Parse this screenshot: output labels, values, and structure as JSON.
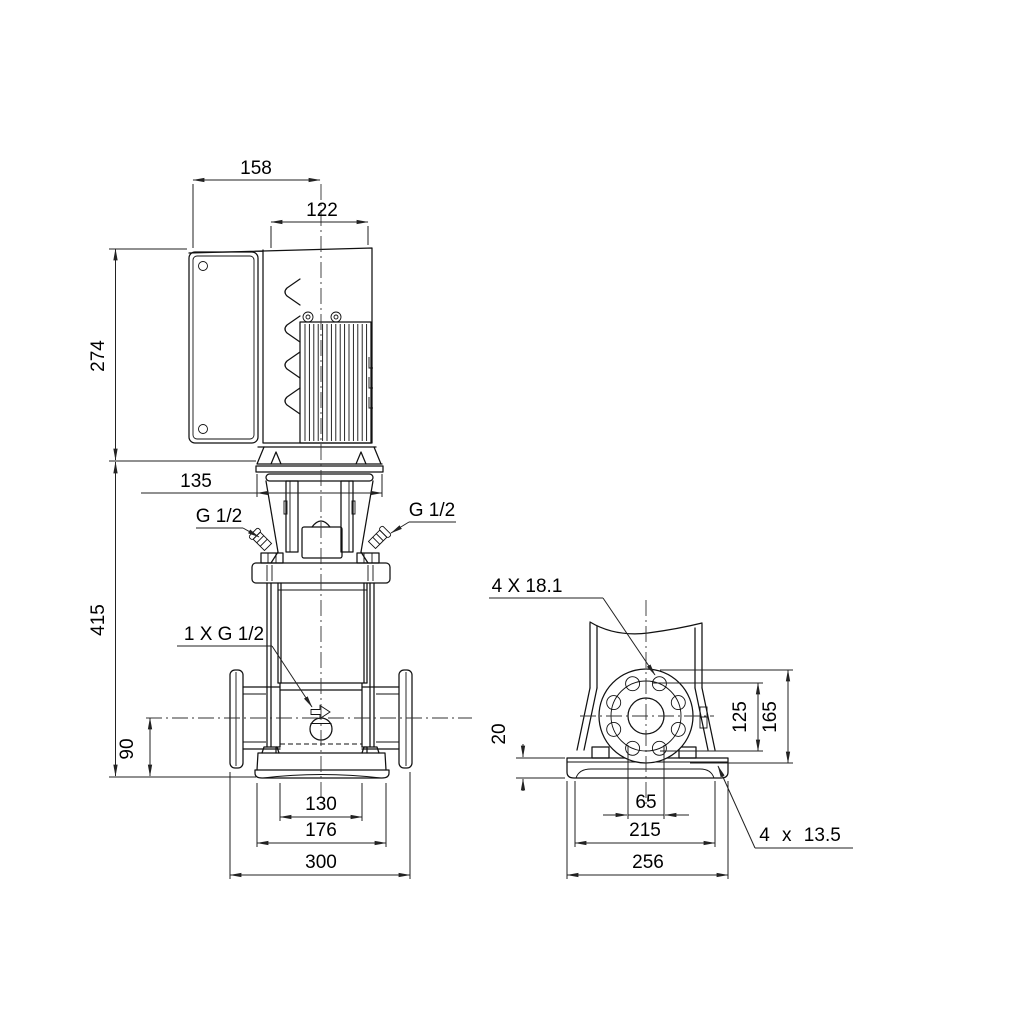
{
  "colors": {
    "background": "#ffffff",
    "line": "#000000"
  },
  "front_view": {
    "dim_total_width": "158",
    "dim_motor_width": "122",
    "dim_motor_height": "274",
    "dim_head_width": "135",
    "dim_pump_height": "415",
    "dim_port_height": "90",
    "dim_chamber_width": "130",
    "dim_base_width": "176",
    "dim_flange_span": "300",
    "label_gauge_left": "G 1/2",
    "label_gauge_right": "G 1/2",
    "label_drain_port": "1 X G 1/2"
  },
  "side_view": {
    "label_flange_holes": "4 X 18.1",
    "dim_bolt_circle": "125",
    "dim_flange_od": "165",
    "dim_plate_height": "20",
    "dim_bore": "65",
    "dim_hole_spacing": "215",
    "dim_plate_width": "256",
    "label_base_holes": "4 x 13.5"
  }
}
